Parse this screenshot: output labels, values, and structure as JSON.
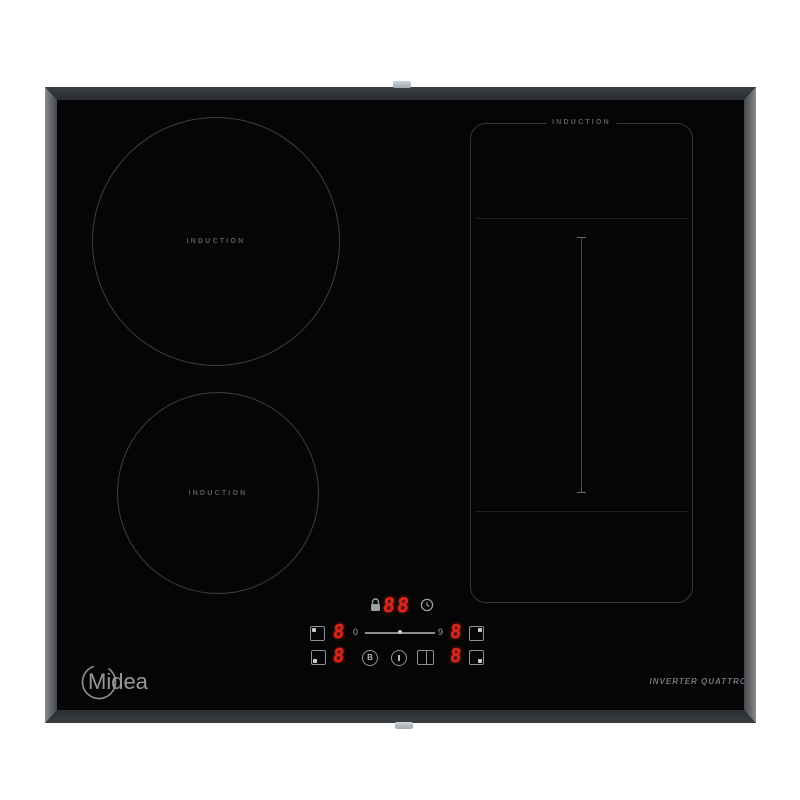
{
  "product": {
    "brand": "Midea",
    "tagline": "INVERTER QUATTRO"
  },
  "zones": {
    "back_left": {
      "label": "INDUCTION"
    },
    "front_left": {
      "label": "INDUCTION"
    },
    "flex_right": {
      "label": "INDUCTION"
    }
  },
  "control_panel": {
    "timer_display": "88",
    "zone_power": {
      "back_left": "8",
      "front_left": "8",
      "back_right": "8",
      "front_right": "8"
    },
    "slider": {
      "min": "0",
      "max": "9"
    },
    "boost_glyph": "B",
    "icons": [
      "lock-icon",
      "timer-clock-icon",
      "power-icon",
      "boost-icon",
      "bridge-zone-icon"
    ]
  },
  "colors": {
    "glass": "#050505",
    "frame_dark": "#2b2e33",
    "frame_side": "#7c7f83",
    "led_red": "#d9241b",
    "zone_outline": "#3d3e3f",
    "label_gray": "#585b5d"
  }
}
